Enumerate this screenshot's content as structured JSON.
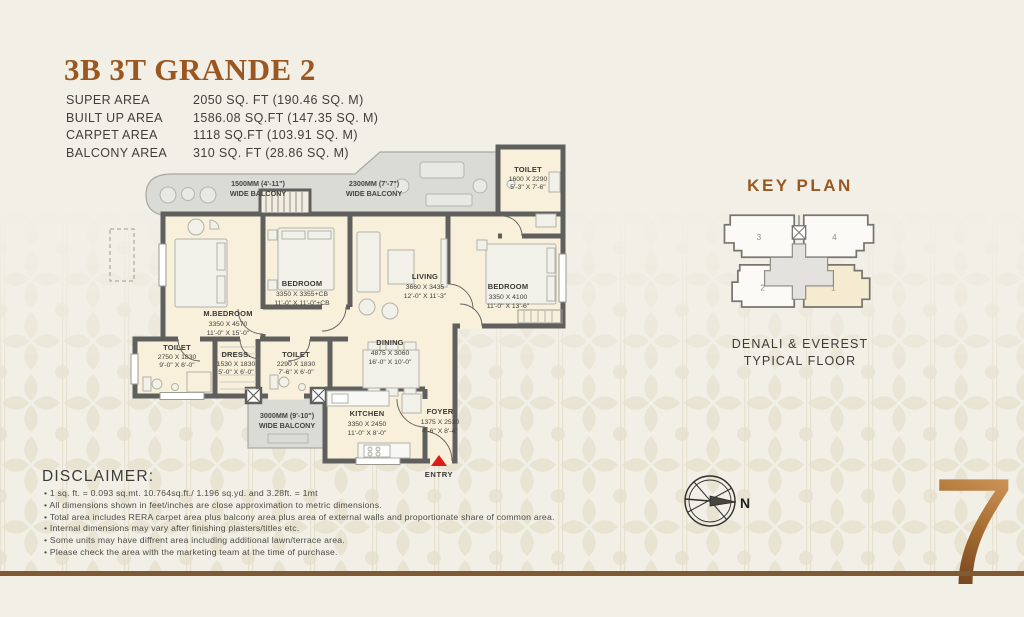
{
  "header": {
    "title": "3B 3T GRANDE 2",
    "areas": [
      {
        "label": "SUPER AREA",
        "value": "2050 SQ. FT (190.46 SQ. M)"
      },
      {
        "label": "BUILT UP AREA",
        "value": "1586.08 SQ.FT (147.35 SQ. M)"
      },
      {
        "label": "CARPET AREA",
        "value": "1118 SQ.FT (103.91 SQ. M)"
      },
      {
        "label": "BALCONY AREA",
        "value": "310 SQ. FT (28.86 SQ. M)"
      }
    ]
  },
  "floorplan": {
    "rooms": [
      {
        "name": "M.BEDROOM",
        "mm": "3350 X 4570",
        "ft": "11'-0\" X 15'-0\""
      },
      {
        "name": "BEDROOM",
        "mm": "3350 X 3355+CB",
        "ft": "11'-0\" X 11'-0\"+CB"
      },
      {
        "name": "LIVING",
        "mm": "3660 X 3435",
        "ft": "12'-0\" X 11'-3\""
      },
      {
        "name": "BEDROOM",
        "mm": "3350 X 4100",
        "ft": "11'-0\" X 13'-6\""
      },
      {
        "name": "TOILET",
        "mm": "2750 X 1830",
        "ft": "9'-0\" X 6'-0\""
      },
      {
        "name": "DRESS.",
        "mm": "1530 X 1830",
        "ft": "5'-0\" X 6'-0\""
      },
      {
        "name": "TOILET",
        "mm": "2290 X 1830",
        "ft": "7'-6\" X 6'-0\""
      },
      {
        "name": "DINING",
        "mm": "4875 X 3060",
        "ft": "16'-0\" X 10'-0\""
      },
      {
        "name": "KITCHEN",
        "mm": "3350 X 2450",
        "ft": "11'-0\" X 8'-0\""
      },
      {
        "name": "FOYER",
        "mm": "1375 X 2530",
        "ft": "4'-6\" X 8'-4\""
      },
      {
        "name": "TOILET",
        "mm": "1600 X 2290",
        "ft": "5'-3\" X 7'-6\""
      }
    ],
    "balconies": [
      {
        "size": "1500MM (4'-11\")",
        "label": "WIDE BALCONY"
      },
      {
        "size": "2300MM (7'-7\")",
        "label": "WIDE BALCONY"
      },
      {
        "size": "3000MM (9'-10\")",
        "label": "WIDE BALCONY"
      }
    ],
    "entry_label": "ENTRY"
  },
  "keyplan": {
    "title": "KEY PLAN",
    "caption_line1": "DENALI & EVEREST",
    "caption_line2": "TYPICAL FLOOR",
    "units": [
      "1",
      "2",
      "3",
      "4"
    ]
  },
  "compass": {
    "north_label": "N"
  },
  "floor_number": "7",
  "disclaimer": {
    "heading": "DISCLAIMER:",
    "bullets": [
      "1 sq. ft. = 0.093 sq.mt. 10.764sq.ft./ 1.196 sq.yd. and 3.28ft. = 1mt",
      "All dimensions shown in feet/inches are close approximation to metric dimensions.",
      "Total area includes RERA carpet area plus balcony area plus area of external walls and proportionate share of common area.",
      "Internal dimensions may vary after finishing plasters/titles etc.",
      "Some units may have diffrent area including additional lawn/terrace area.",
      "Please check the area with the marketing team at the time of purchase."
    ]
  },
  "colors": {
    "accent_brown": "#9a571f",
    "wall_gray": "#5f5f5d",
    "room_cream": "#f8f0da",
    "balcony_gray": "#dbdbd6",
    "entry_red": "#e01b1b",
    "bottom_line_brown": "#7e5b35",
    "number_gradient": [
      "#d39c5e",
      "#6d3d1a"
    ]
  }
}
